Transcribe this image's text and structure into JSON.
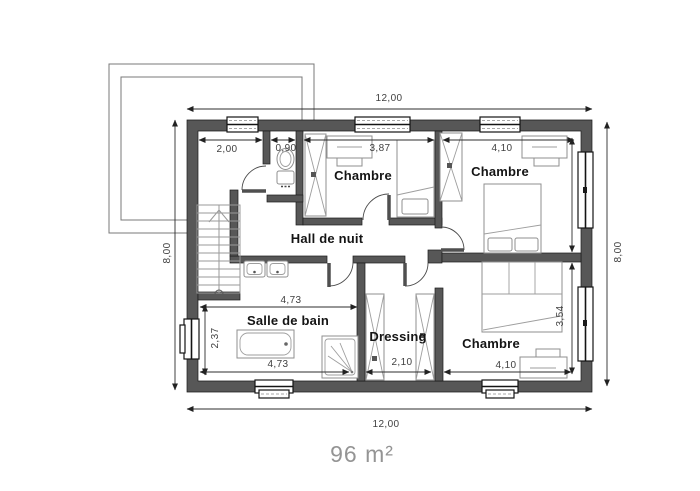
{
  "plan": {
    "area_label": "96 m²",
    "rooms": {
      "bedroom_top_left": "Chambre",
      "bedroom_top_right": "Chambre",
      "bedroom_bottom_right": "Chambre",
      "night_hall": "Hall de nuit",
      "bathroom": "Salle de bain",
      "dressing": "Dressing"
    },
    "exterior_dims": {
      "top": "12,00",
      "bottom": "12,00",
      "left": "8,00",
      "right": "8,00"
    },
    "interior_dims": {
      "storage_width": "2,00",
      "wc_width": "0,90",
      "bedroom_top_left_width": "3,87",
      "bedroom_top_right_width": "4,10",
      "bathroom_top_width": "4,73",
      "bathroom_depth": "2,37",
      "bathroom_bottom_width": "4,73",
      "dressing_width": "2,10",
      "bedroom_bottom_right_width": "4,10",
      "bedroom_bottom_right_depth": "3,54"
    }
  }
}
